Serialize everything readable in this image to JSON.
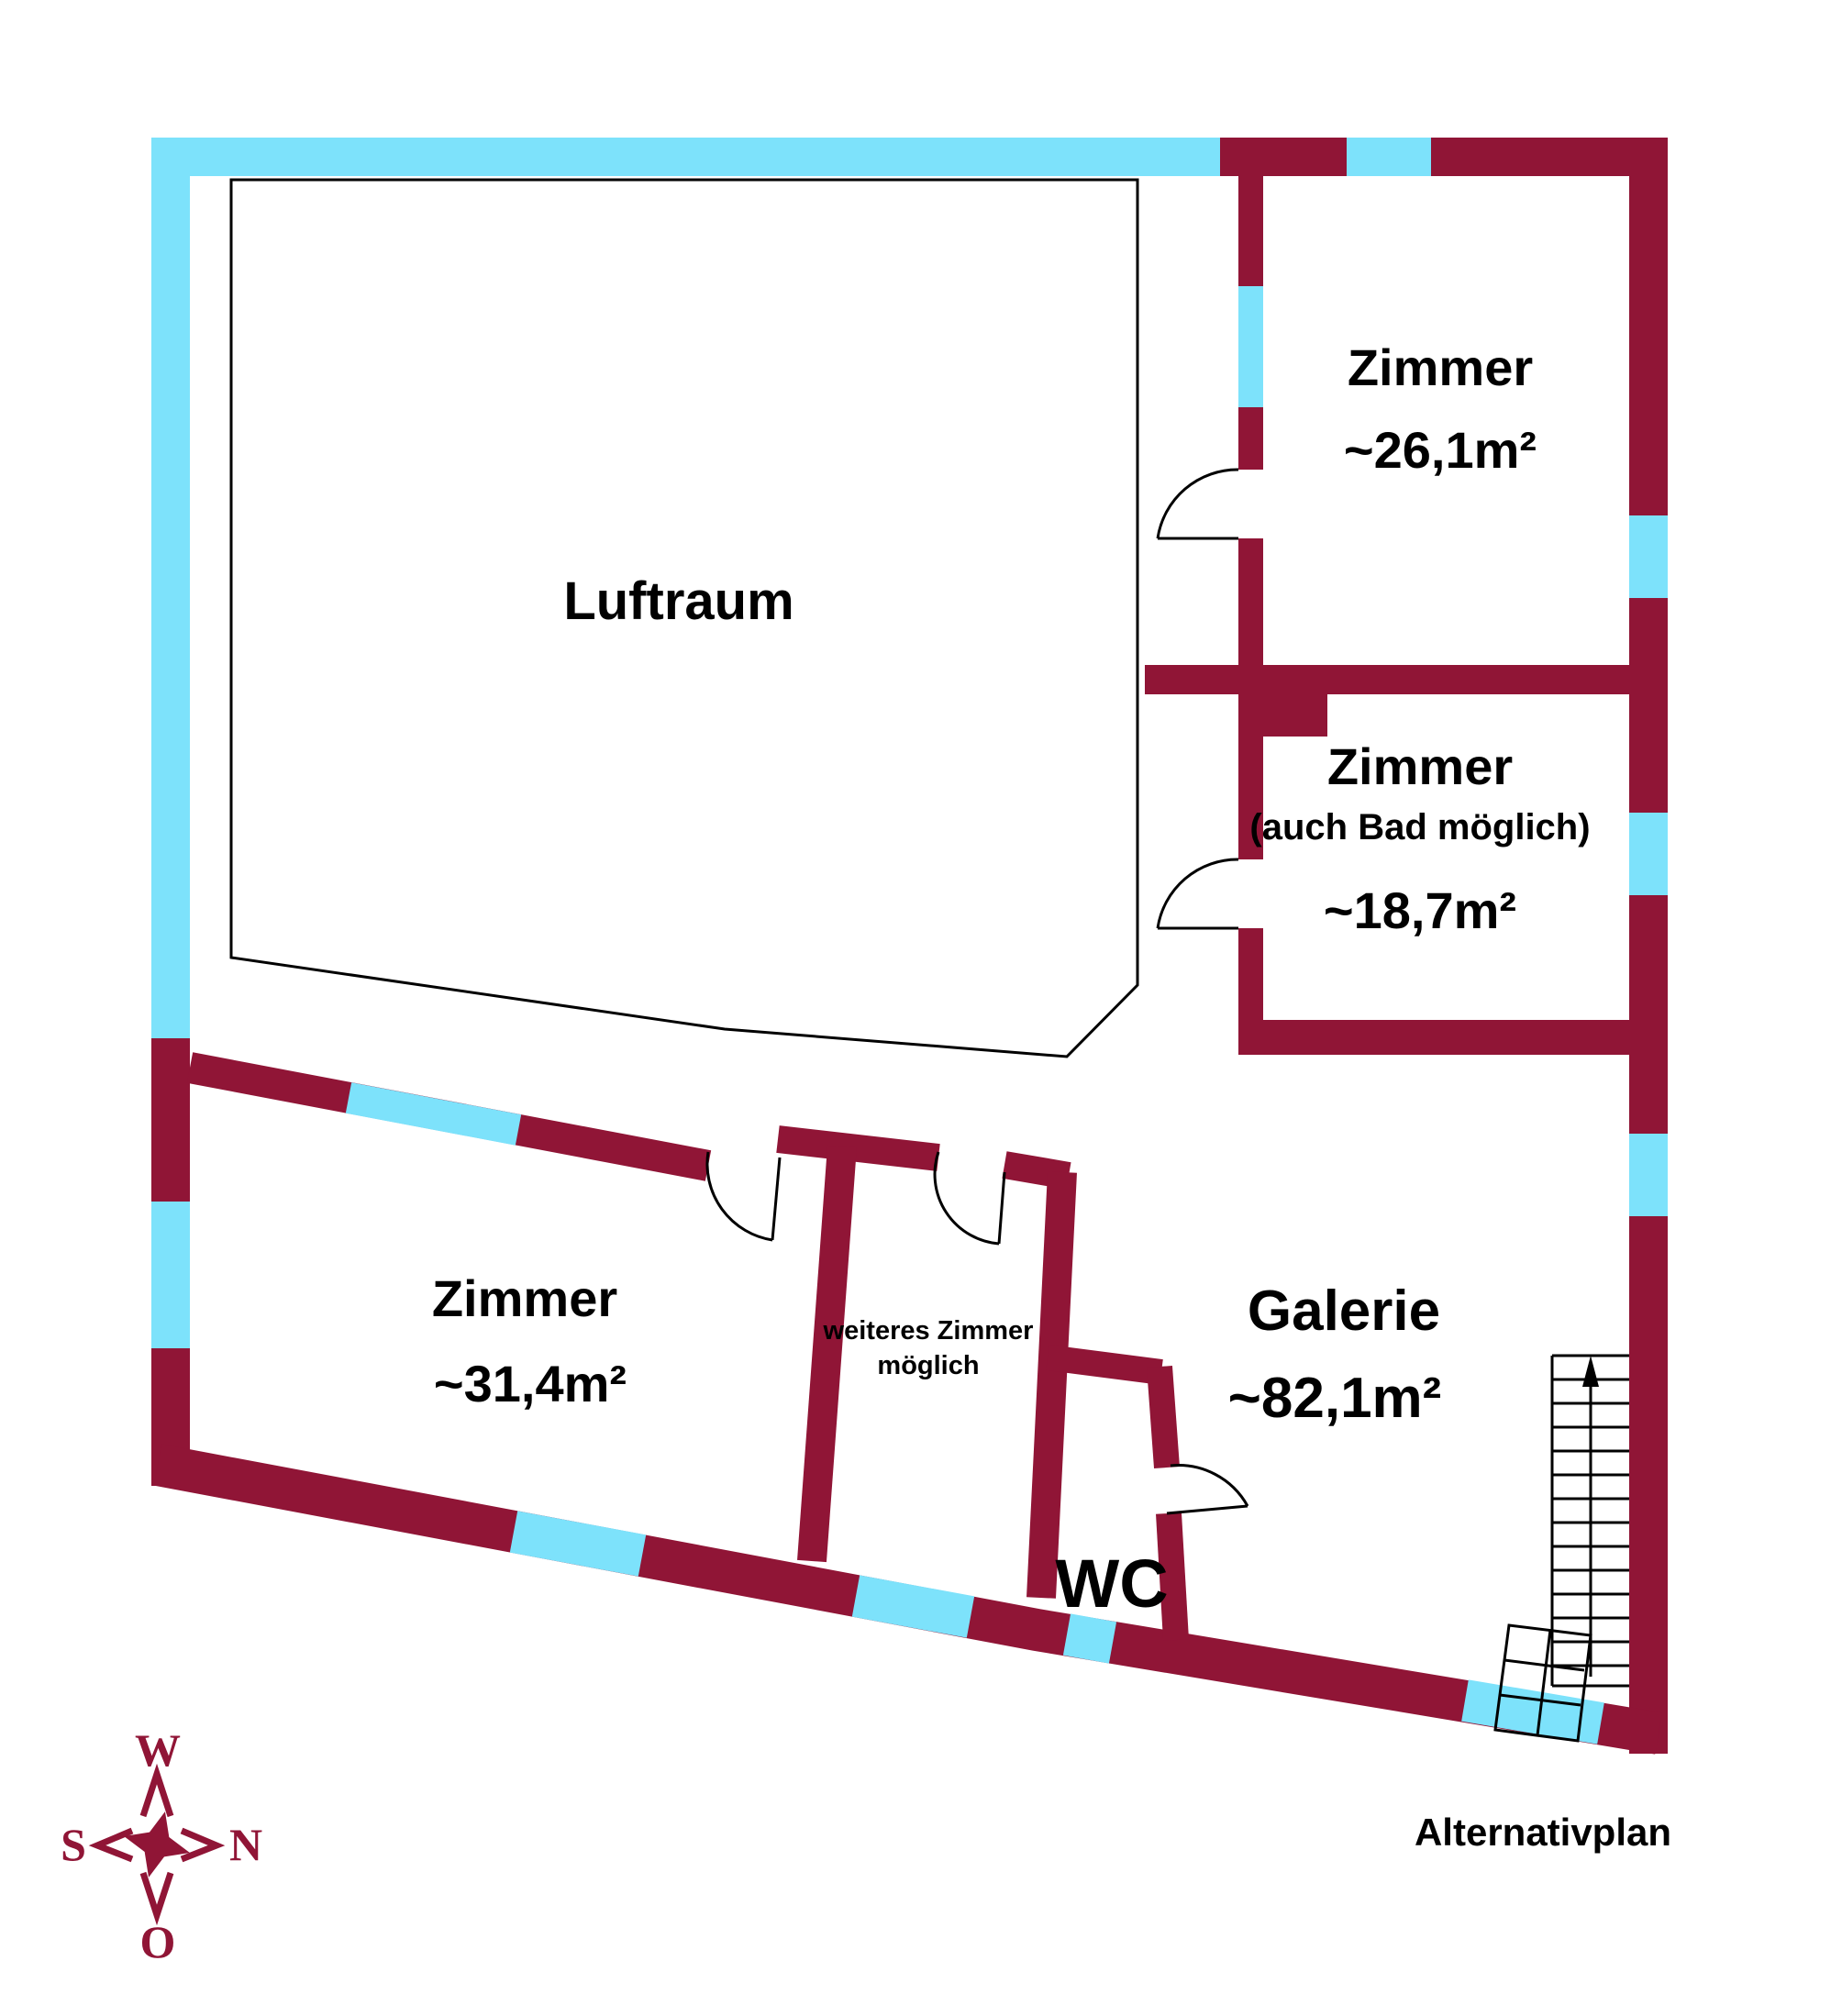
{
  "plan": {
    "title": "Alternativplan"
  },
  "colors": {
    "wall": "#901536",
    "window": "#7DE2FB",
    "text": "#000000"
  },
  "rooms": {
    "luftraum": {
      "name": "Luftraum"
    },
    "zimmer_top_right": {
      "name": "Zimmer",
      "area": "~26,1m²"
    },
    "zimmer_mid_right": {
      "name": "Zimmer",
      "note": "(auch Bad möglich)",
      "area": "~18,7m²"
    },
    "zimmer_bottom_left": {
      "name": "Zimmer",
      "area": "~31,4m²"
    },
    "weiteres_zimmer": {
      "line1": "weiteres Zimmer",
      "line2": "möglich"
    },
    "galerie": {
      "name": "Galerie",
      "area": "~82,1m²"
    },
    "wc": {
      "name": "WC"
    }
  },
  "compass": {
    "up": "W",
    "right": "N",
    "left": "S",
    "down": "O"
  },
  "icons": {
    "stairs_direction": "up-arrow-icon"
  }
}
